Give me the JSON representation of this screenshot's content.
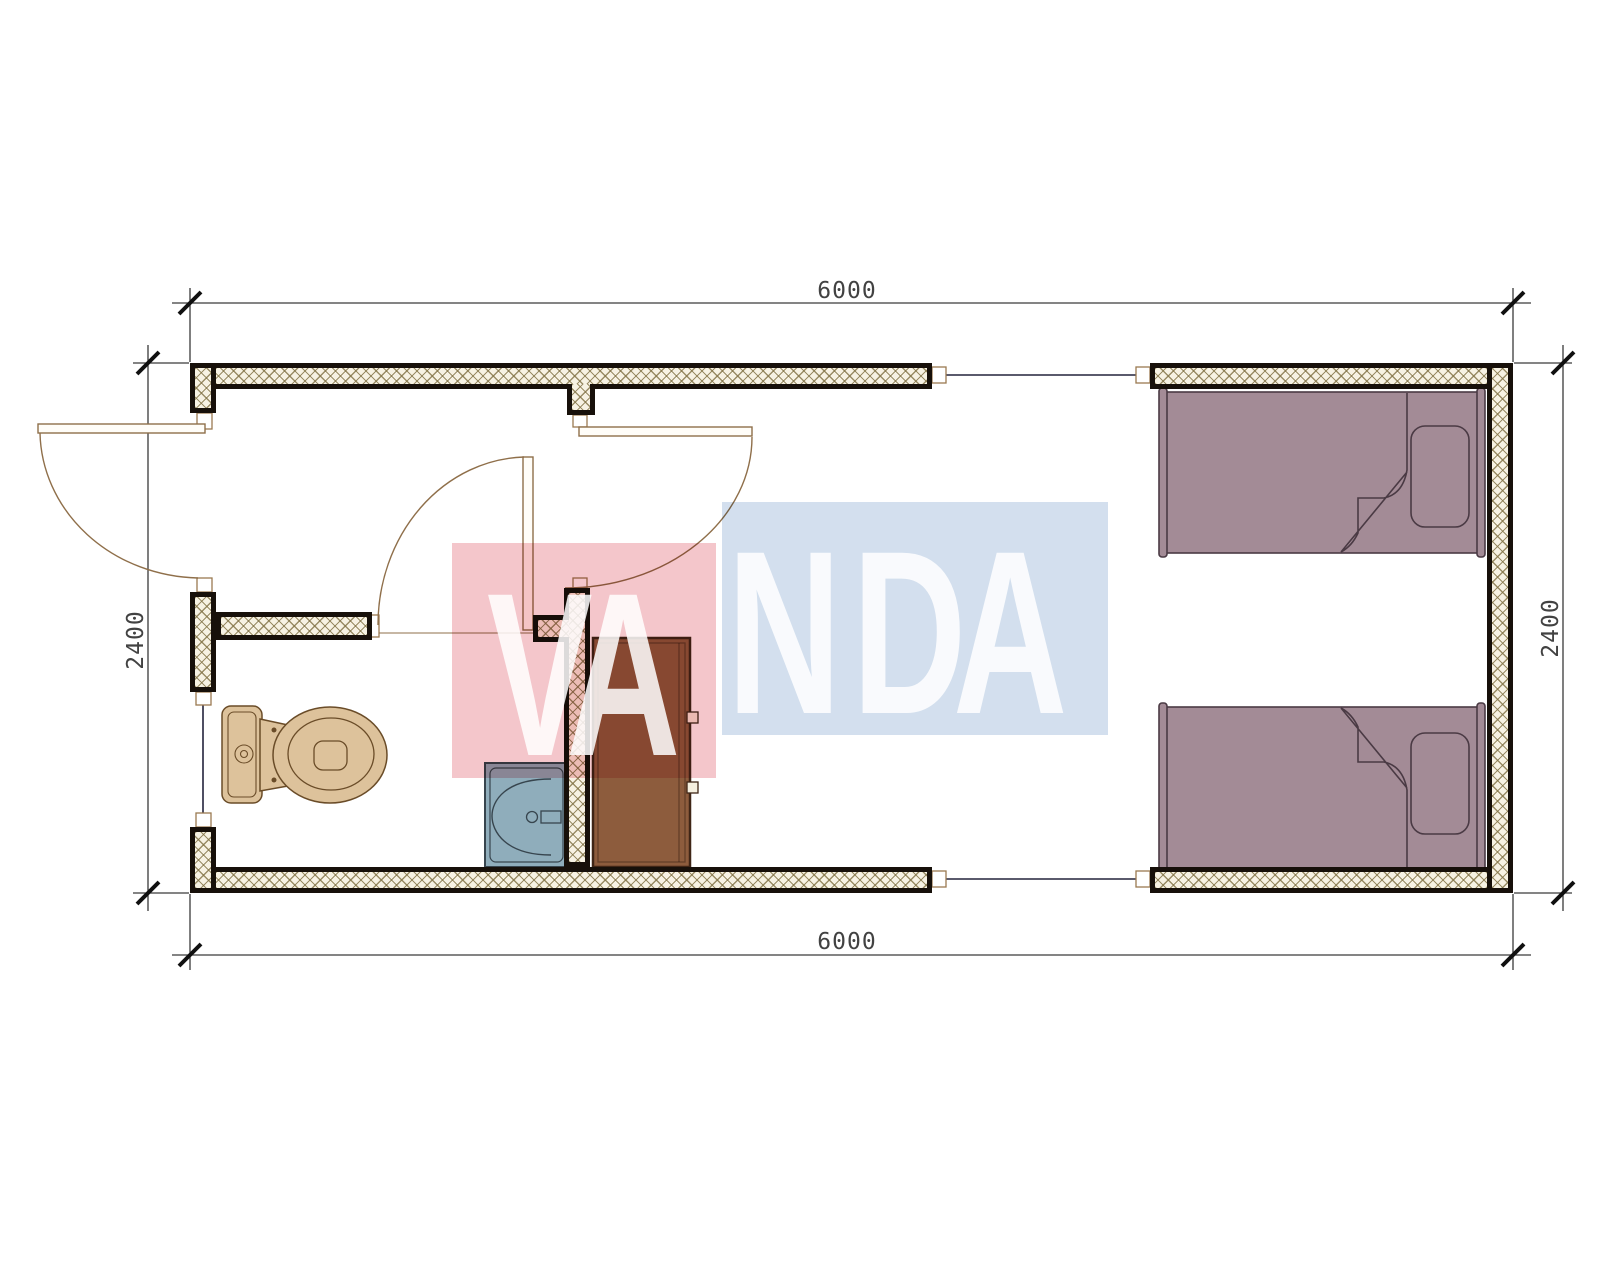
{
  "dimensions": {
    "top": {
      "label": "6000"
    },
    "bottom": {
      "label": "6000"
    },
    "left": {
      "label": "2400"
    },
    "right": {
      "label": "2400"
    }
  },
  "watermark": {
    "letters": [
      {
        "ch": "V"
      },
      {
        "ch": "A"
      },
      {
        "ch": "N"
      },
      {
        "ch": "D"
      },
      {
        "ch": "A"
      }
    ],
    "pink_block_color": "#f4c6cb",
    "blue_block_color": "#d3dfee",
    "letter_color": "rgba(255,255,255,0.85)"
  },
  "colors": {
    "wall_fill": "#f7f2e3",
    "wall_hatch": "#827346",
    "wall_border": "#17100a",
    "bed_fill": "#a38b96",
    "bed_outline": "#4a3a44",
    "wardrobe_fill": "#8d5c3d",
    "wardrobe_outline": "#3f2516",
    "sink_fill": "#8fadbb",
    "sink_outline": "#37454e",
    "toilet_fill": "#ddc29b",
    "toilet_outline": "#6a4c28",
    "door_line": "#8f6f4a",
    "window_line": "#23233c",
    "dimension_line": "#3a3a3a",
    "dimension_text": "#424242"
  }
}
